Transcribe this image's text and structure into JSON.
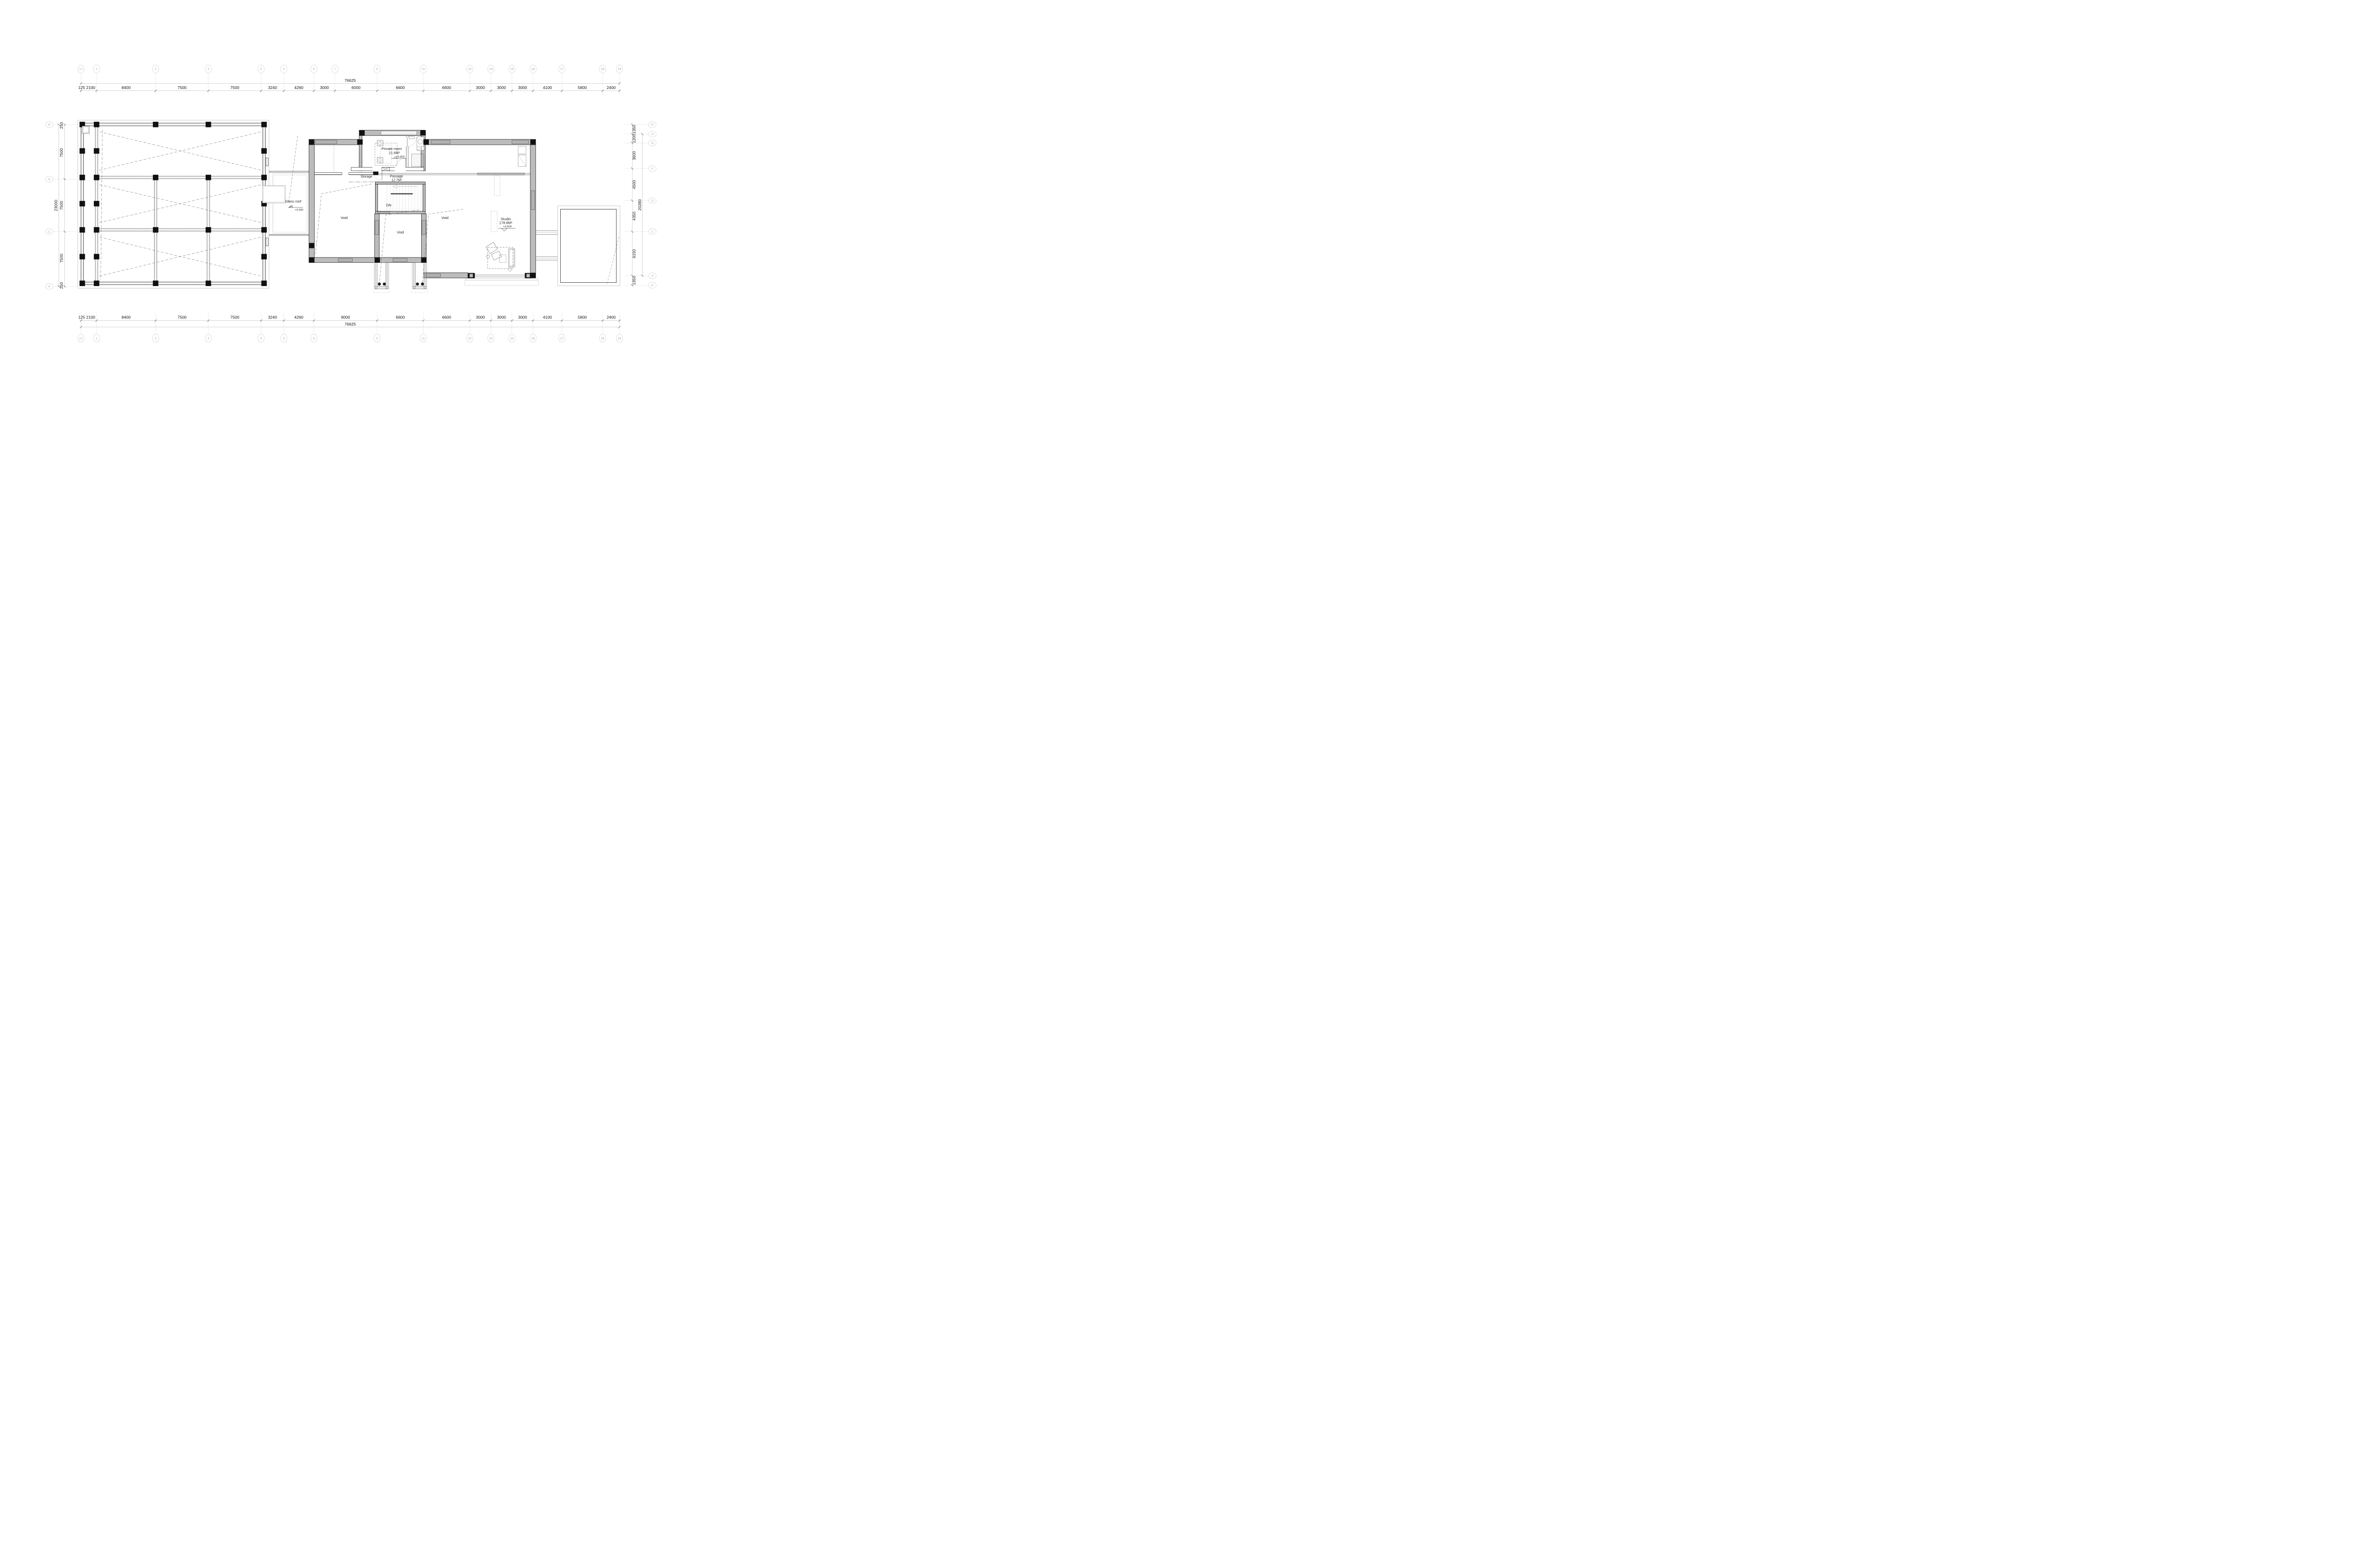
{
  "drawing": {
    "type": "floor-plan",
    "overall_width_label": "76625",
    "overall_height_left_label": "23000",
    "overall_height_right_label": "20280"
  },
  "colors": {
    "wall_fill": "#bcbcbc",
    "line": "#161616",
    "grid_line": "#cfcfcf",
    "bubble_stroke": "#bdbdbd",
    "bubble_text": "#a9a9a9",
    "dim_text": "#141414",
    "dash": "#555555"
  },
  "grid": {
    "top": {
      "total": "76625",
      "bubbles": [
        [
          "1/1",
          680
        ],
        [
          "1",
          811
        ],
        [
          "2",
          1307
        ],
        [
          "3",
          1750
        ],
        [
          "4",
          2193
        ],
        [
          "5",
          2384
        ],
        [
          "6",
          2636
        ],
        [
          "7",
          2813
        ],
        [
          "9",
          3167
        ],
        [
          "11",
          3556
        ],
        [
          "13",
          3946
        ],
        [
          "14",
          4123
        ],
        [
          "15",
          4300
        ],
        [
          "16",
          4477
        ],
        [
          "17",
          4719
        ],
        [
          "18",
          5062
        ],
        [
          "19",
          5203
        ]
      ],
      "dims": [
        [
          "125",
          686
        ],
        [
          "2100",
          762
        ],
        [
          "8400",
          1059
        ],
        [
          "7500",
          1529
        ],
        [
          "7500",
          1972
        ],
        [
          "3240",
          2289
        ],
        [
          "4260",
          2510
        ],
        [
          "3000",
          2725
        ],
        [
          "6000",
          2990
        ],
        [
          "6600",
          3362
        ],
        [
          "6600",
          3751
        ],
        [
          "3000",
          4035
        ],
        [
          "3000",
          4212
        ],
        [
          "3000",
          4389
        ],
        [
          "4100",
          4598
        ],
        [
          "5800",
          4891
        ],
        [
          "2400",
          5133
        ]
      ]
    },
    "bottom": {
      "total": "76625",
      "bubbles": [
        [
          "1/1",
          680
        ],
        [
          "1",
          811
        ],
        [
          "2",
          1307
        ],
        [
          "3",
          1750
        ],
        [
          "4",
          2193
        ],
        [
          "5",
          2384
        ],
        [
          "6",
          2636
        ],
        [
          "9",
          3167
        ],
        [
          "11",
          3556
        ],
        [
          "13",
          3946
        ],
        [
          "14",
          4123
        ],
        [
          "15",
          4300
        ],
        [
          "16",
          4477
        ],
        [
          "17",
          4719
        ],
        [
          "18",
          5062
        ],
        [
          "19",
          5203
        ]
      ],
      "dims": [
        [
          "125",
          686
        ],
        [
          "2100",
          762
        ],
        [
          "8400",
          1059
        ],
        [
          "7500",
          1529
        ],
        [
          "7500",
          1972
        ],
        [
          "3240",
          2289
        ],
        [
          "4260",
          2510
        ],
        [
          "9000",
          2902
        ],
        [
          "6600",
          3362
        ],
        [
          "6600",
          3751
        ],
        [
          "3000",
          4035
        ],
        [
          "3000",
          4212
        ],
        [
          "3000",
          4389
        ],
        [
          "4100",
          4598
        ],
        [
          "5800",
          4891
        ],
        [
          "2400",
          5133
        ]
      ]
    },
    "left": {
      "total": "23000",
      "bubbles": [
        [
          "H'",
          1046
        ],
        [
          "E",
          1504
        ],
        [
          "C",
          1945
        ],
        [
          "A'",
          2405
        ]
      ],
      "dims": [
        [
          "250",
          1053
        ],
        [
          "7500",
          1282
        ],
        [
          "7500",
          1725
        ],
        [
          "7500",
          2168
        ],
        [
          "250",
          2397
        ]
      ]
    },
    "right": {
      "total": "20280",
      "bubbles": [
        [
          "H'",
          1046
        ],
        [
          "H",
          1126
        ],
        [
          "G",
          1200
        ],
        [
          "F",
          1415
        ],
        [
          "D",
          1685
        ],
        [
          "C",
          1945
        ],
        [
          "A",
          2315
        ],
        [
          "A'",
          2395
        ]
      ],
      "dims": [
        [
          "1350",
          1086
        ],
        [
          "1200",
          1163
        ],
        [
          "3600",
          1307
        ],
        [
          "4500",
          1550
        ],
        [
          "4350",
          1815
        ],
        [
          "6150",
          2130
        ],
        [
          "1350",
          2355
        ]
      ]
    }
  },
  "labels": {
    "private_room": {
      "name": "Private room",
      "area": "21.6M²",
      "level": "+3.600"
    },
    "storage": "Storage",
    "passage": {
      "name": "Passage",
      "area": "12.7M²"
    },
    "stair_dn": "DN",
    "void1": "Void",
    "void2": "Void",
    "void3": "Void",
    "glass_roof": {
      "name": "Glass roof",
      "level": "+3.600"
    },
    "studio": {
      "name": "Studio",
      "area": "178.8M²",
      "level": "+3.600"
    }
  }
}
